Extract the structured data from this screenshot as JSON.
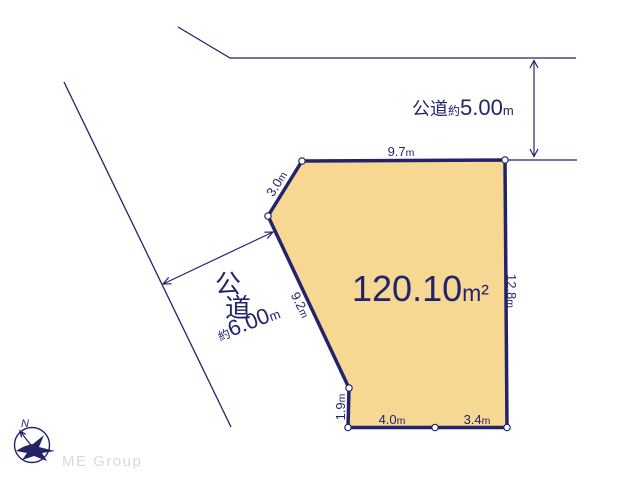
{
  "colors": {
    "navy": "#23236B",
    "plot_fill": "#F6D892",
    "vertex_dot_fill": "#FFFFFF",
    "logo_gray": "#D9D9D9"
  },
  "plot": {
    "area": {
      "value": "120.10",
      "unit": "m²"
    },
    "edges": [
      {
        "side": "top",
        "value": "9.7",
        "unit": "m"
      },
      {
        "side": "upper-left",
        "value": "3.0",
        "unit": "m"
      },
      {
        "side": "left",
        "value": "9.2",
        "unit": "m"
      },
      {
        "side": "lower-left",
        "value": "1.9",
        "unit": "m"
      },
      {
        "side": "bottom-left",
        "value": "4.0",
        "unit": "m"
      },
      {
        "side": "bottom-right",
        "value": "3.4",
        "unit": "m"
      },
      {
        "side": "right",
        "value": "12.8",
        "unit": "m"
      }
    ]
  },
  "roads": {
    "top": {
      "name": "公道",
      "approx": "約",
      "width": "5.00",
      "unit": "m"
    },
    "left": {
      "name_chars": [
        "公",
        "道"
      ],
      "approx": "約",
      "width": "6.00",
      "unit": "m"
    }
  },
  "compass": {
    "label": "N"
  },
  "branding": {
    "logo": "ME Group"
  }
}
